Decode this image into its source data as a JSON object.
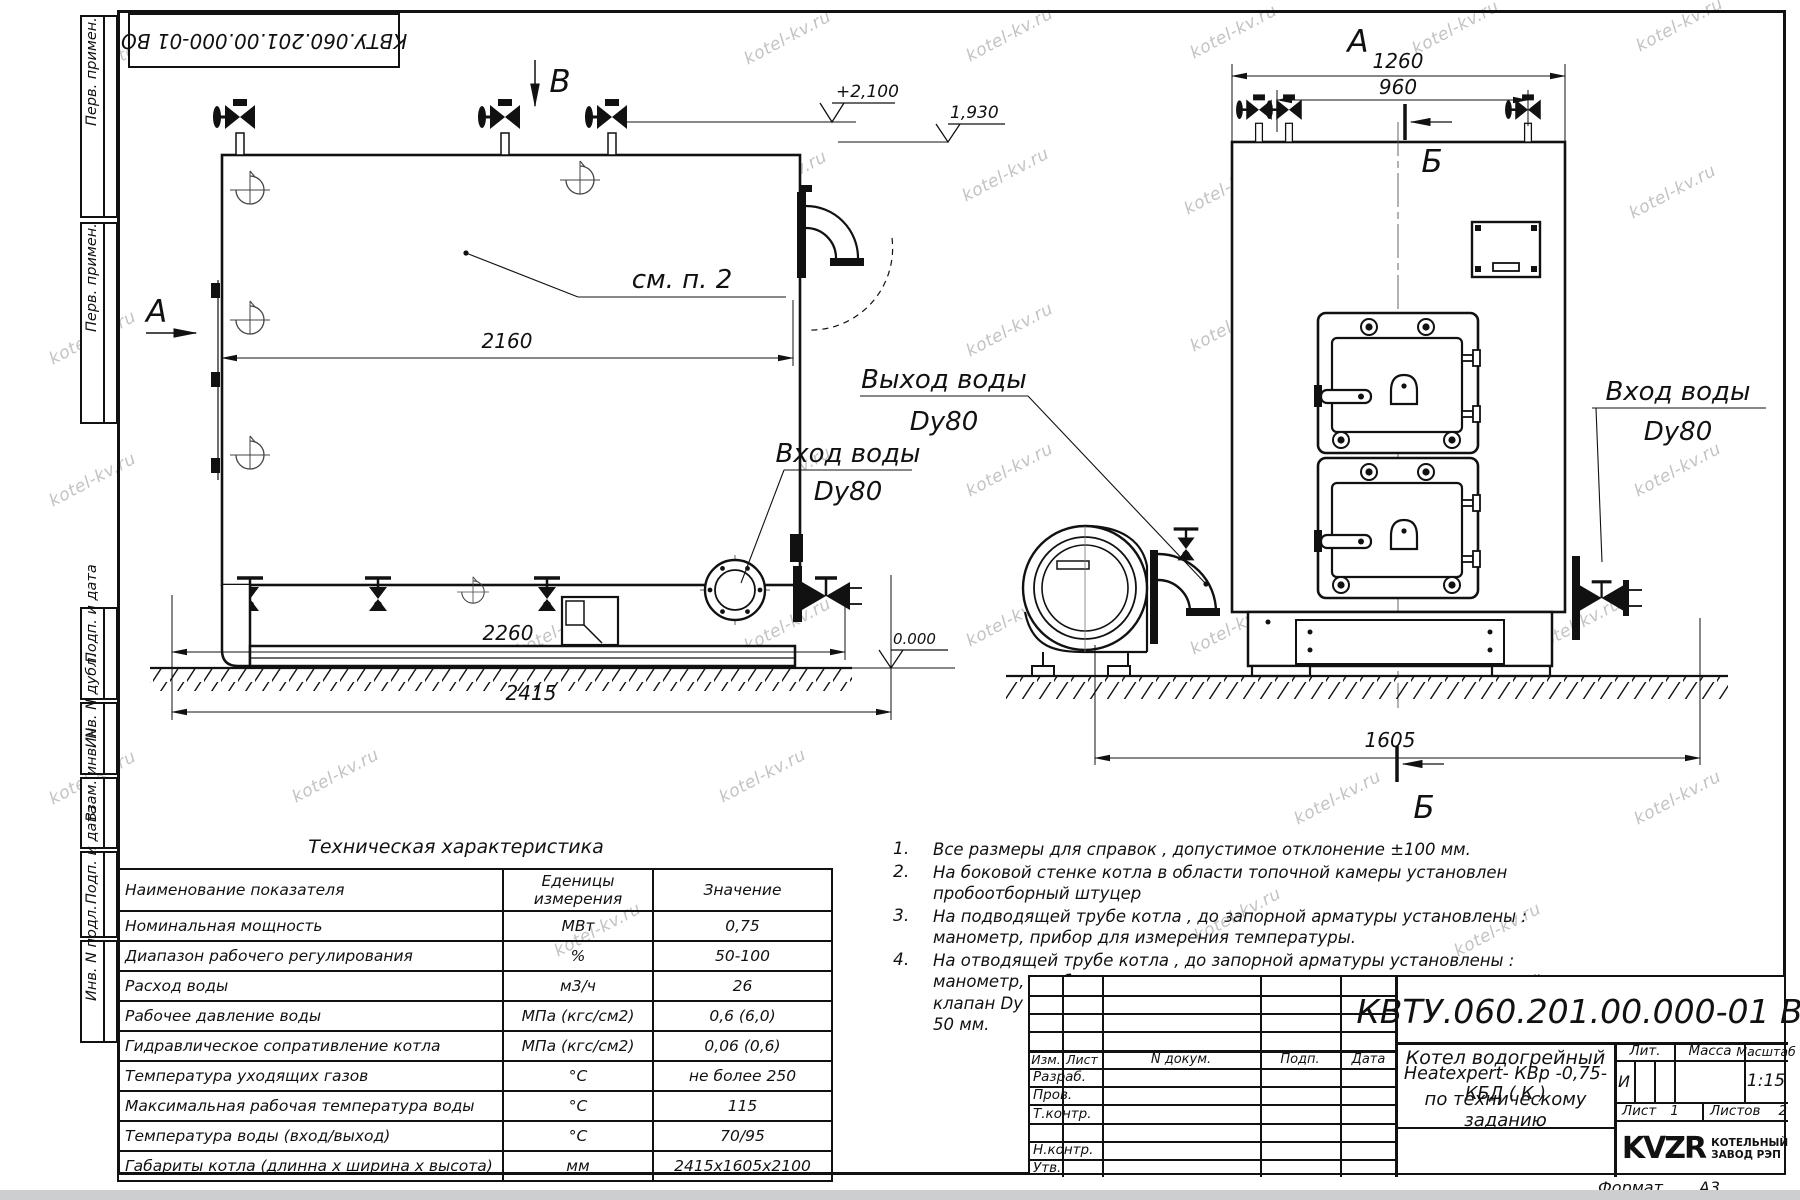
{
  "watermark": {
    "text": "kotel-kv.ru"
  },
  "stamp_top": {
    "doc_number": "КВТУ.060.201.00.000-01 ВО"
  },
  "margin": {
    "items": [
      {
        "label": "Перв. примен."
      },
      {
        "label": "Перв. примен."
      },
      {
        "label": "Подп. и дата"
      },
      {
        "label": "Инв. N дубл."
      },
      {
        "label": "Взам. инв. N"
      },
      {
        "label": "Подп. и дата"
      },
      {
        "label": "Инв. N подл."
      }
    ]
  },
  "views": {
    "side": {
      "label_v": "В",
      "label_a": "А",
      "callout": "см. п. 2",
      "dim_width": "2160",
      "dim_base": "2260",
      "dim_total": "2415",
      "elev_top": "+2,100",
      "elev_mid": "1,930",
      "elev_zero": "0.000",
      "inlet_title": "Вход воды",
      "inlet_dn": "Dy80"
    },
    "front": {
      "label_a": "А",
      "label_b_top": "Б",
      "label_b_bottom": "Б",
      "dim_width": "1260",
      "dim_valves": "960",
      "dim_depth": "1605",
      "outlet_title": "Выход воды",
      "outlet_dn": "Dy80",
      "inlet_title": "Вход воды",
      "inlet_dn": "Dy80"
    }
  },
  "tech_table": {
    "title": "Техническая характеристика",
    "headers": {
      "name": "Наименование показателя",
      "unit_line1": "Еденицы",
      "unit_line2": "измерения",
      "value": "Значение"
    },
    "rows": [
      {
        "name": "Номинальная мощность",
        "unit": "МВт",
        "value": "0,75"
      },
      {
        "name": "Диапазон рабочего регулирования",
        "unit": "%",
        "value": "50-100"
      },
      {
        "name": "Расход воды",
        "unit": "м3/ч",
        "value": "26"
      },
      {
        "name": "Рабочее давление воды",
        "unit": "МПа (кгс/см2)",
        "value": "0,6 (6,0)"
      },
      {
        "name": "Гидравлическое сопративление котла",
        "unit": "МПа (кгс/см2)",
        "value": "0,06 (0,6)"
      },
      {
        "name": "Температура уходящих газов",
        "unit": "°С",
        "value": "не более 250"
      },
      {
        "name": "Максимальная рабочая температура воды",
        "unit": "°С",
        "value": "115"
      },
      {
        "name": "Температура воды (вход/выход)",
        "unit": "°С",
        "value": "70/95"
      },
      {
        "name": "Габариты котла (длинна х ширина х высота)",
        "unit": "мм",
        "value": "2415х1605х2100"
      }
    ]
  },
  "notes": {
    "items": [
      {
        "num": "1.",
        "text": "Все размеры для справок , допустимое отклонение  ±100 мм."
      },
      {
        "num": "2.",
        "text": "На боковой стенке котла в области топочной камеры установлен пробоотборный штуцер"
      },
      {
        "num": "3.",
        "text": "На  подводящей трубе котла , до запорной арматуры установлены :  манометр, прибор для измерения температуры."
      },
      {
        "num": "4.",
        "text": "На отводящей трубе котла , до запорной арматуры установлены :  манометр, прибор для измерения температуры, предохранительный клапан  Dу не менее  50 мм и обвод с обратным клапаном  Dу не менее  50 мм."
      }
    ]
  },
  "title_block": {
    "doc_number": "КВТУ.060.201.00.000-01  ВО",
    "product_line1": "Котел водогрейный",
    "product_line2": "Heatexpert- КВр -0,75- КБД ( К )",
    "product_line3": "по техническому заданию",
    "cols": {
      "izm": "Изм.",
      "list": "Лист",
      "n_dokum": "N докум.",
      "podp": "Подп.",
      "data": "Дата"
    },
    "rows": {
      "razrab": "Разраб.",
      "prov": "Пров.",
      "tkontr": "Т.контр.",
      "nkontr": "Н.контр.",
      "utv": "Утв."
    },
    "lit_header": "Лит.",
    "lit_value": "И",
    "massa_header": "Масса",
    "masshtab_header": "Масштаб",
    "masshtab_value": "1:15",
    "list_label": "Лист",
    "list_value": "1",
    "listov_label": "Листов",
    "listov_value": "2",
    "logo_text": "KVZR",
    "org_line1": "КОТЕЛЬНЫЙ",
    "org_line2": "ЗАВОД РЭП",
    "format_label": "Формат",
    "format_value": "А3"
  }
}
